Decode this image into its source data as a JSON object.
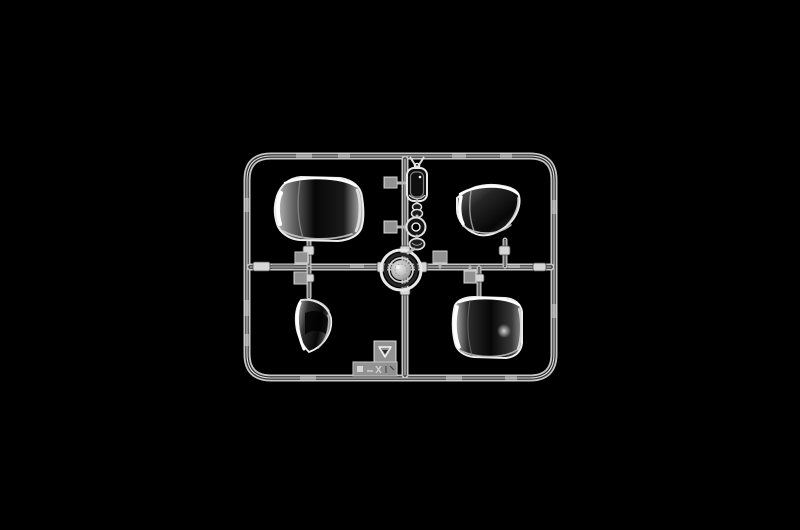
{
  "scene": {
    "description": "Clear transparent injection-molded sprue of model kit window parts photographed on a pure black background",
    "background_color": "#000000"
  },
  "palette": {
    "background": "#000000",
    "rail_bright": "#e9e9e9",
    "rail_mid": "#b0b0b0",
    "rail_core": "#2e2e2e",
    "glass_edge": "#f0f0f0",
    "glass_bright": "#c6c6c6",
    "glass_mid": "#6f6f6f",
    "glass_dark": "#070707",
    "pad_base": "#8e8e8e",
    "pad_dark": "#5e5e5e",
    "pad_light": "#c6c6c6",
    "ring_rim": "#e8e8e8",
    "ring_disc": "#b9b9b9"
  },
  "sprue": {
    "frame_label": "rounded rectangular runner frame with cross runners",
    "parts": [
      {
        "id": "windscreen-large",
        "label": "large curved windscreen",
        "quadrant": "top-left"
      },
      {
        "id": "windscreen-front",
        "label": "wraparound front windscreen",
        "quadrant": "top-right"
      },
      {
        "id": "quarter-window",
        "label": "small curved quarter window",
        "quadrant": "bottom-left"
      },
      {
        "id": "rear-window",
        "label": "large rounded rear window",
        "quadrant": "bottom-right"
      },
      {
        "id": "headlamp-ring",
        "label": "round clear lens ring at runner crossing",
        "quadrant": "center"
      },
      {
        "id": "lens-rect",
        "label": "small rectangular lens",
        "quadrant": "top-center"
      },
      {
        "id": "lens-link",
        "label": "small twin-bulb link piece",
        "quadrant": "top-center"
      },
      {
        "id": "lens-donut",
        "label": "small round donut lens",
        "quadrant": "top-center"
      },
      {
        "id": "lens-oval",
        "label": "small oval lens",
        "quadrant": "top-center"
      }
    ],
    "markings": [
      {
        "id": "recycle-stamp",
        "label": "molded recycling-triangle stamp tab"
      },
      {
        "id": "code-stamp",
        "label": "embossed part-code stamp tab, lettering illegible"
      }
    ]
  }
}
